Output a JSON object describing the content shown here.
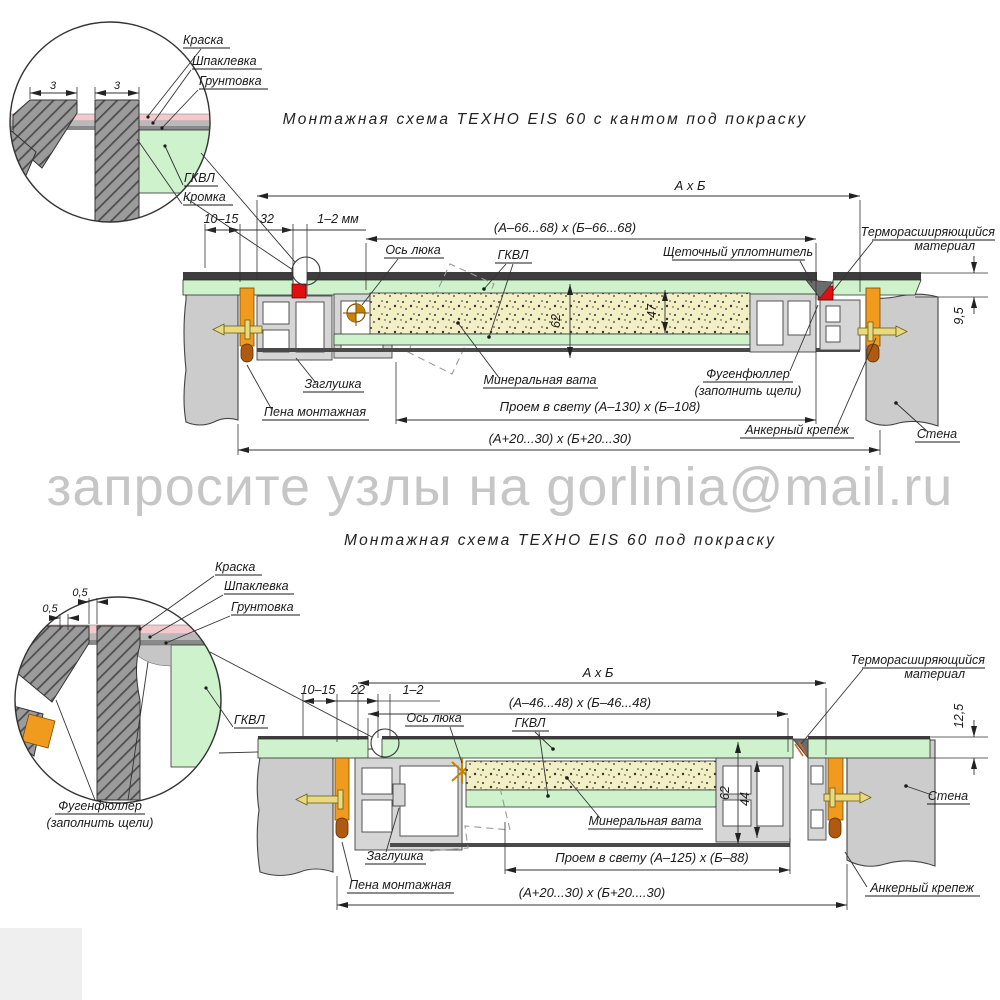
{
  "watermark": "запросите узлы на gorlinia@mail.ru",
  "colors": {
    "green": "#cdf2cc",
    "wool": "#f3efc5",
    "orange": "#f09a1e",
    "red": "#e01010",
    "pink": "#f2c9cd",
    "wall_gray": "#cccccc",
    "watermark_gray": "#c6c6c6"
  },
  "top": {
    "title": "Монтажная  схема  ТЕХНО  EIS  60  с  кантом  под  покраску",
    "detail": {
      "paint": "Краска",
      "putty": "Шпаклевка",
      "primer": "Грунтовка",
      "gkvl": "ГКВЛ",
      "edge": "Кромка",
      "dim_left": "3",
      "dim_right": "3"
    },
    "dims": {
      "overall": "А х Б",
      "leaf": "(А–66...68) х (Б–66...68)",
      "gap_wall": "10–15",
      "offset": "32",
      "joint": "1–2 мм",
      "depth": "62",
      "wool_thickness": "47",
      "board": "9,5",
      "clear_opening": "Проем в свету (А–130) х (Б–108)",
      "wall_opening": "(А+20...30) х (Б+20...30)"
    },
    "labels": {
      "axis": "Ось люка",
      "gkvl": "ГКВЛ",
      "brush_seal": "Щеточный уплотнитель",
      "thermo_1": "Терморасширяющийся",
      "thermo_2": "материал",
      "plug": "Заглушка",
      "wool": "Минеральная вата",
      "fugen_1": "Фугенфюллер",
      "fugen_2": "(заполнить щели)",
      "foam": "Пена монтажная",
      "anchor": "Анкерный крепеж",
      "wall": "Стена"
    }
  },
  "bottom": {
    "title": "Монтажная  схема  ТЕХНО  EIS  60  под  покраску",
    "detail": {
      "paint": "Краска",
      "putty": "Шпаклевка",
      "primer": "Грунтовка",
      "gkvl": "ГКВЛ",
      "dim_1": "0,5",
      "dim_2": "0,5",
      "fugen_1": "Фугенфюллер",
      "fugen_2": "(заполнить щели)"
    },
    "dims": {
      "overall": "А х Б",
      "leaf": "(А–46...48) х (Б–46...48)",
      "gap_wall": "10–15",
      "offset": "22",
      "joint": "1–2",
      "depth": "62",
      "inner_depth": "44",
      "board": "12,5",
      "clear_opening": "Проем в свету (А–125) х (Б–88)",
      "wall_opening": "(А+20...30) х (Б+20....30)"
    },
    "labels": {
      "axis": "Ось люка",
      "gkvl": "ГКВЛ",
      "thermo_1": "Терморасширяющийся",
      "thermo_2": "материал",
      "plug": "Заглушка",
      "wool": "Минеральная вата",
      "foam": "Пена монтажная",
      "anchor": "Анкерный крепеж",
      "wall": "Стена"
    }
  }
}
